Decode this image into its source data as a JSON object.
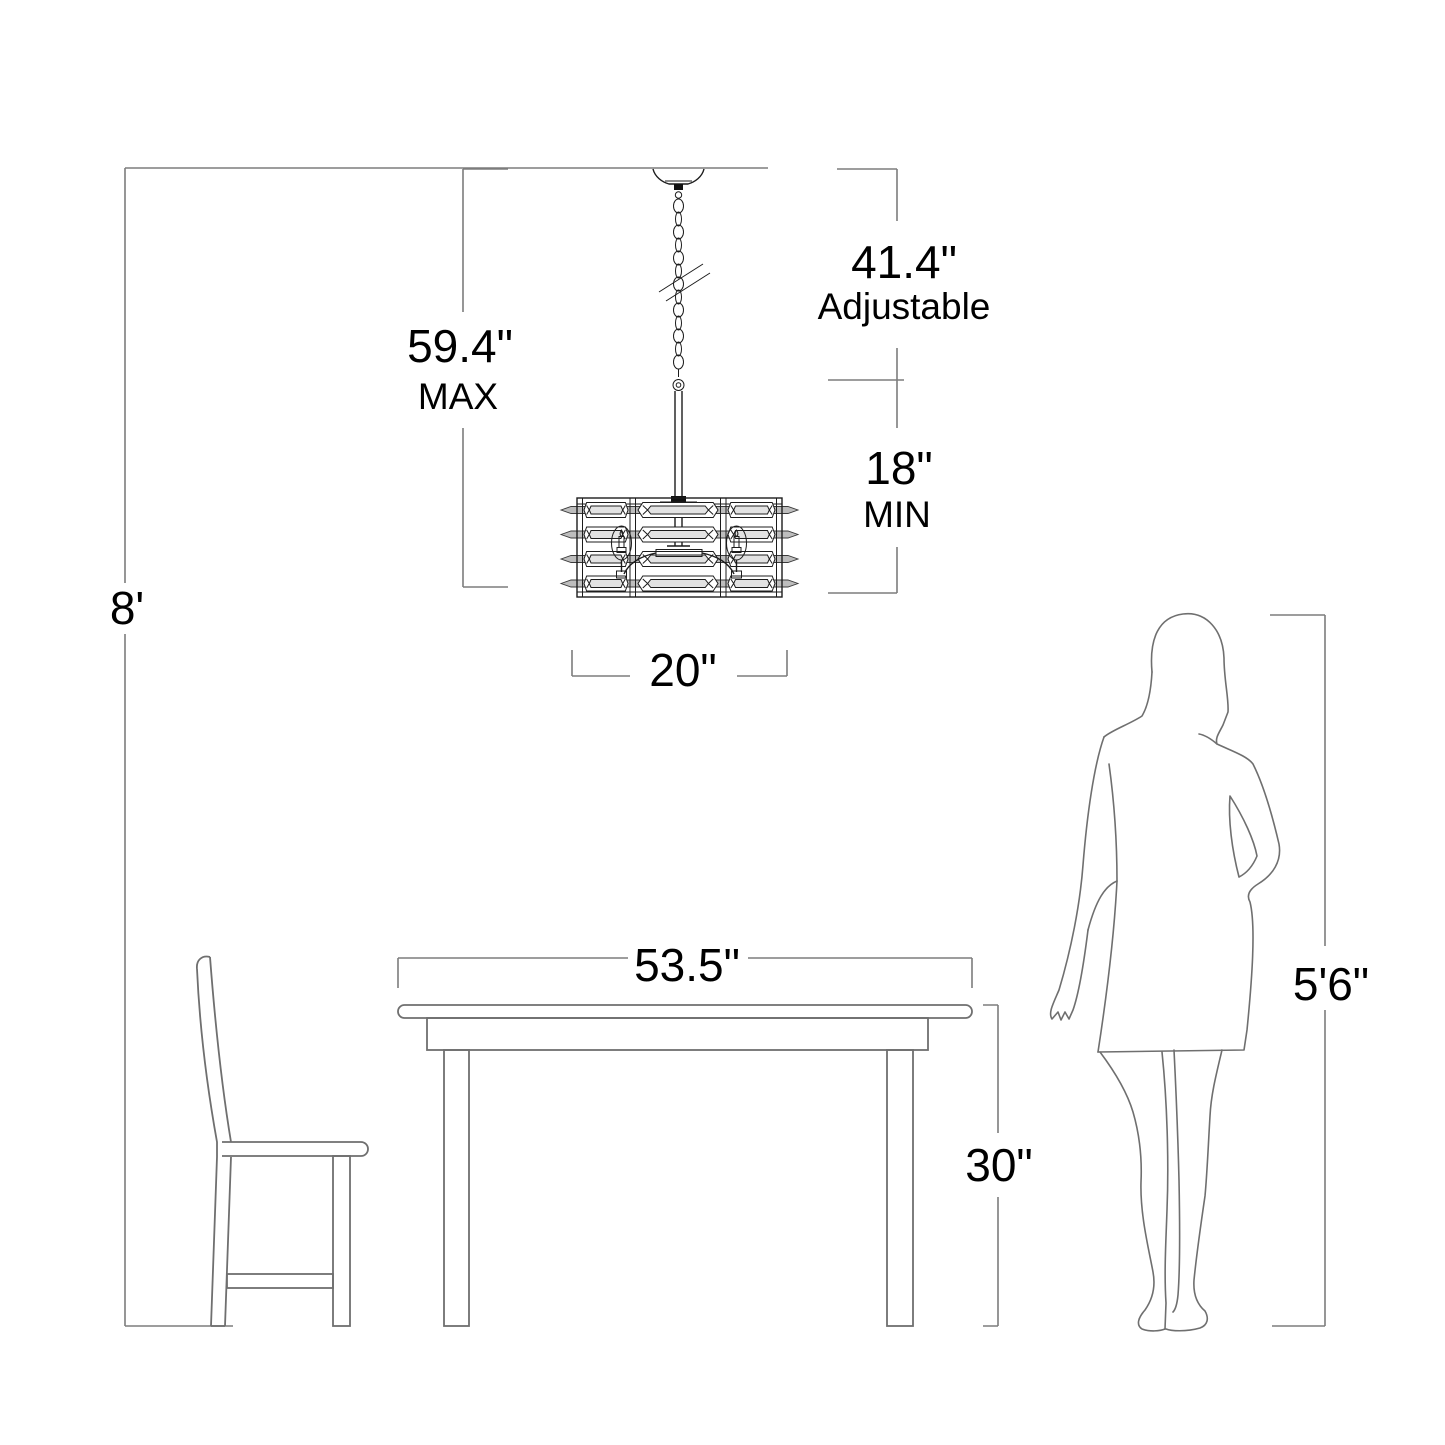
{
  "diagram": {
    "type": "lighting-fixture-dimension-diagram",
    "colors": {
      "background": "#ffffff",
      "dimension_lines": "#7d7d7d",
      "furniture_lines": "#6f6f6f",
      "fixture_lines": "#1c1c1c",
      "crystal_fill": "#bdbdbd",
      "text": "#000000"
    },
    "dims": {
      "ceiling_height": "8'",
      "max_value": "59.4\"",
      "max_word": "MAX",
      "adjustable_value": "41.4\"",
      "adjustable_word": "Adjustable",
      "min_value": "18\"",
      "min_word": "MIN",
      "fixture_width": "20\"",
      "table_width": "53.5\"",
      "table_height": "30\"",
      "person_height": "5'6\""
    }
  }
}
